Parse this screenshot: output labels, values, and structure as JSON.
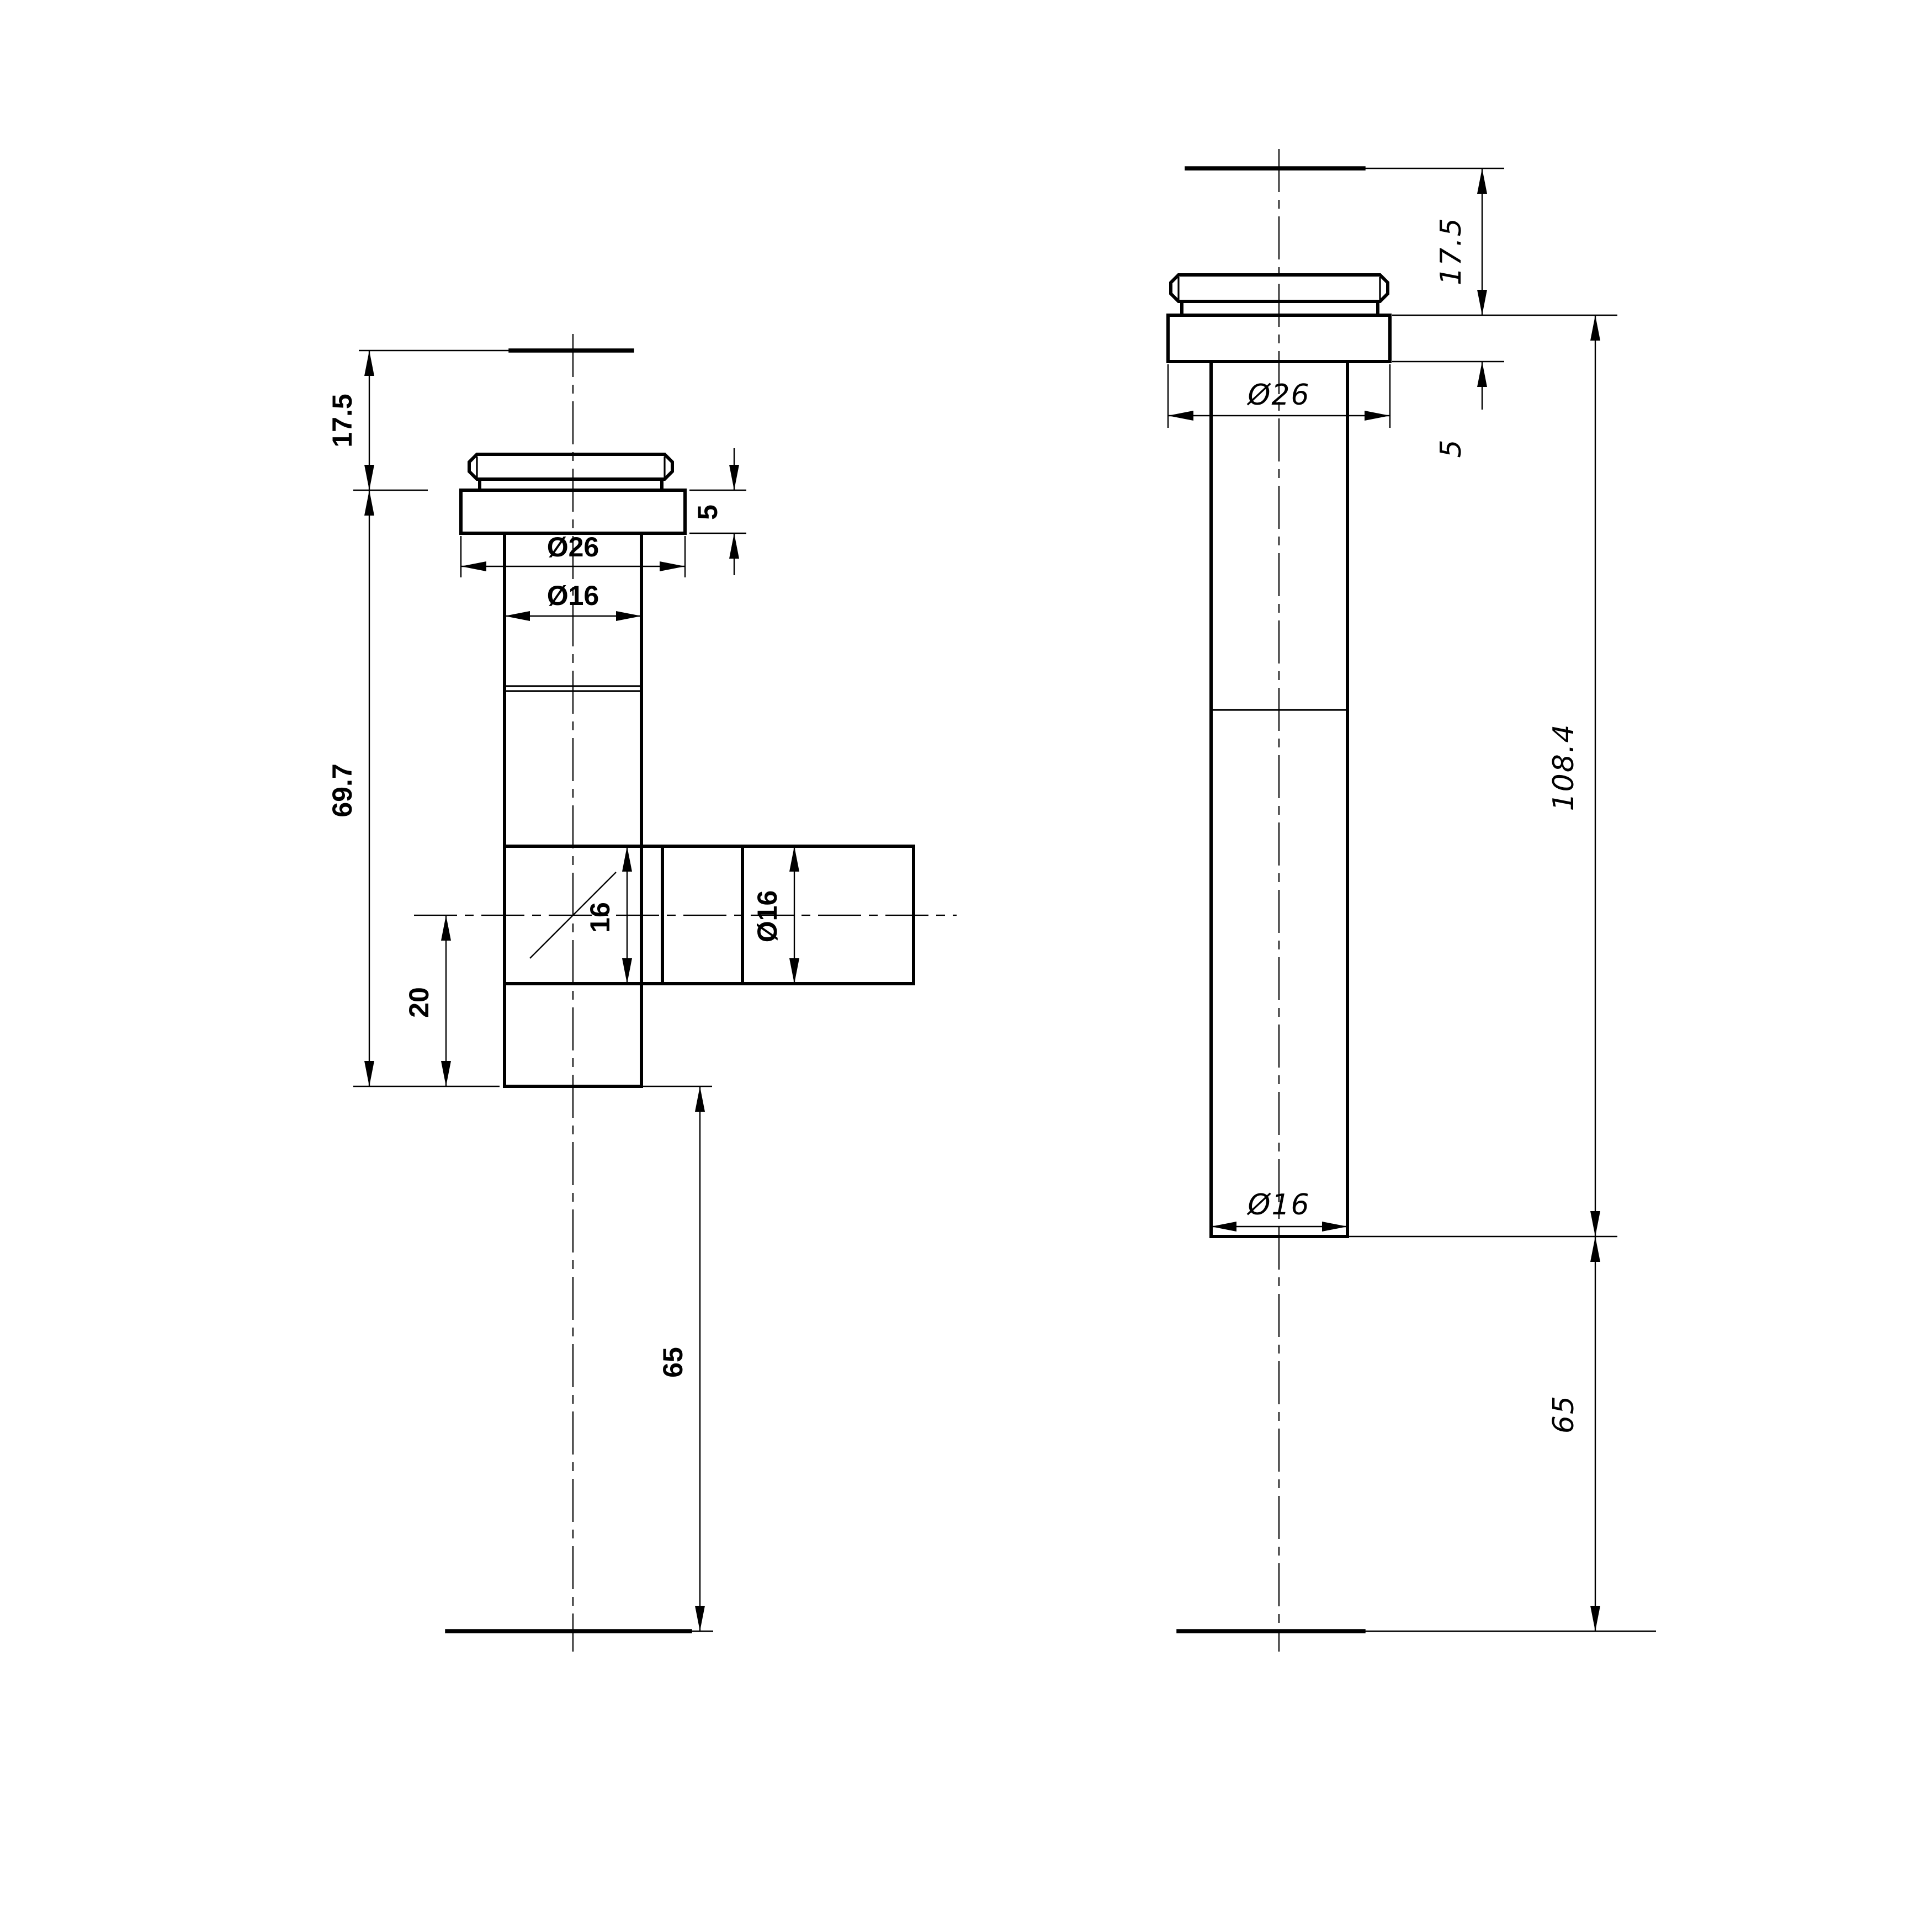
{
  "drawing": {
    "type": "technical-drawing",
    "description": "Two-view CAD drawing of a glass-mounted pipe fitting (front view with side branch tee, side view straight pipe)",
    "background_color": "#ffffff",
    "line_color": "#000000",
    "front_view": {
      "name": "front-view",
      "dims": {
        "top_height": "17.5",
        "flange_thickness": "5",
        "flange_diameter": "Ø26",
        "pipe_diameter": "Ø16",
        "body_length": "69.7",
        "branch_bore": "16",
        "branch_diameter": "Ø16",
        "lower_stub_length": "20",
        "tail_length": "65"
      }
    },
    "side_view": {
      "name": "side-view",
      "dims": {
        "top_height": "17.5",
        "flange_thickness": "5",
        "flange_diameter": "Ø26",
        "overall_length": "108.4",
        "pipe_diameter": "Ø16",
        "tail_length": "65"
      }
    },
    "dimensions_mm": {
      "front": [
        17.5,
        5,
        26,
        16,
        69.7,
        16,
        16,
        20,
        65
      ],
      "side": [
        17.5,
        5,
        26,
        108.4,
        16,
        65
      ]
    }
  }
}
